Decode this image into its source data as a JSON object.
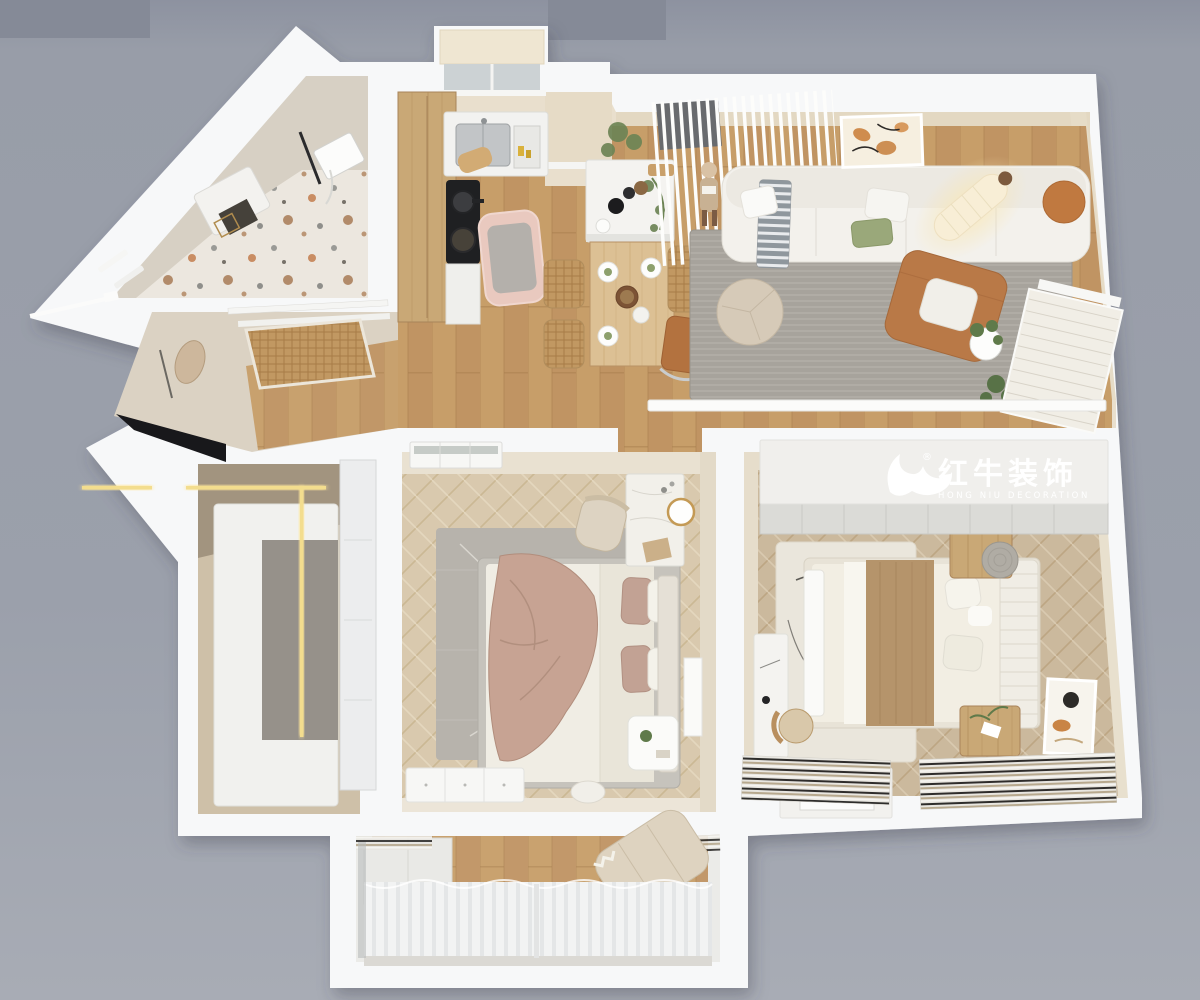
{
  "brand": {
    "logo_cn": "红牛装饰",
    "logo_en": "HONG NIU DECORATION",
    "registered": "®"
  },
  "icons": {
    "logo_mark": "bull-swoosh-icon"
  },
  "palette": {
    "background": "#9ba0ab",
    "background_top": "#878c99",
    "background_bottom": "#a7abb4",
    "wall": "#f7f8f9",
    "cream_wall": "#e9dfcd",
    "cream_dark": "#ddd2bd",
    "floor_oak": "#c79e69",
    "floor_herringbone": "#d9c9ae",
    "floor_bed2": "#cbb99d",
    "rug_gray": "#a7a39c",
    "rug_master": "#b7b3ac",
    "rug_cream": "#eae6dc",
    "terrazzo": "#ece7df",
    "wood": "#c9a876",
    "sofa": "#f3f1ec",
    "leather": "#b97947",
    "pillow_green": "#9aa87a",
    "blanket_mauve": "#c7a393",
    "blanket_tan": "#b5946b",
    "lamp_glow": "#f8eed6",
    "led": "#f3dd8e",
    "cooktop": "#1f2022",
    "pink_rug": "#e9c9bf",
    "curtain": "#f3f4f4",
    "logo_panel": "#f0efec",
    "logo_text": "#ffffff"
  }
}
